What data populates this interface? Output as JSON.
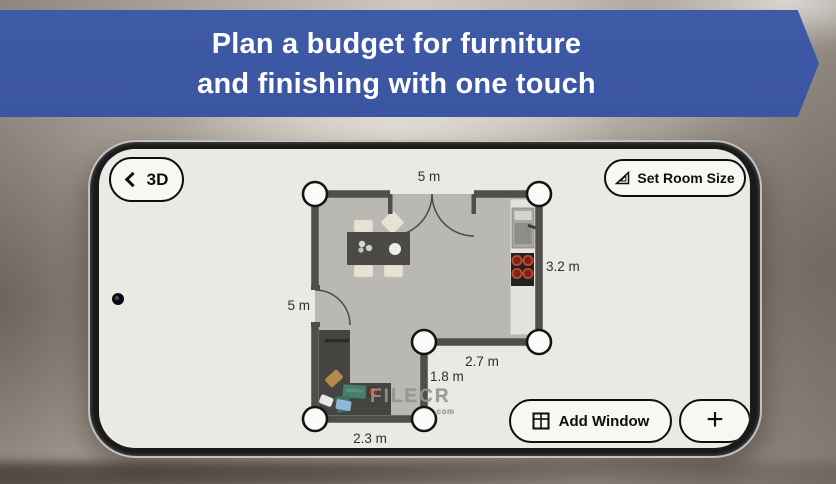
{
  "banner": {
    "line1": "Plan a budget for furniture",
    "line2": "and finishing with one touch"
  },
  "toolbar": {
    "back_label": "3D",
    "set_room_size_label": "Set Room Size",
    "add_window_label": "Add Window",
    "plus_label": "+"
  },
  "floor_plan": {
    "dimension_labels": {
      "top_wall": "5 m",
      "right_wall": "3.2 m",
      "left_wall": "5 m",
      "notch_width": "2.7 m",
      "notch_height": "1.8 m",
      "bottom_wall": "2.3 m"
    },
    "corner_handle_count": 6,
    "elements": [
      "double-entry-door",
      "single-door",
      "dining-table-with-chairs",
      "kitchen-counter",
      "sink-unit",
      "stove-4-burners",
      "corner-sofa-with-pillows",
      "side-table"
    ]
  },
  "watermark": {
    "text": "FILECR",
    "suffix": ".com"
  },
  "icons": {
    "back": "chevron-left",
    "set_room_size": "set-square",
    "add_window": "window-grid",
    "add": "plus",
    "camera": "punch-hole-camera"
  },
  "colors": {
    "banner_blue": "#3c57a4",
    "banner_text": "#ffffff",
    "screen_bg": "#eae9e4",
    "floor": "#b9b8b3",
    "wall": "#4f4e49",
    "burner_red": "#b7452f",
    "handle_stroke": "#141414",
    "sofa": "#454440",
    "table": "#4b4a46"
  }
}
